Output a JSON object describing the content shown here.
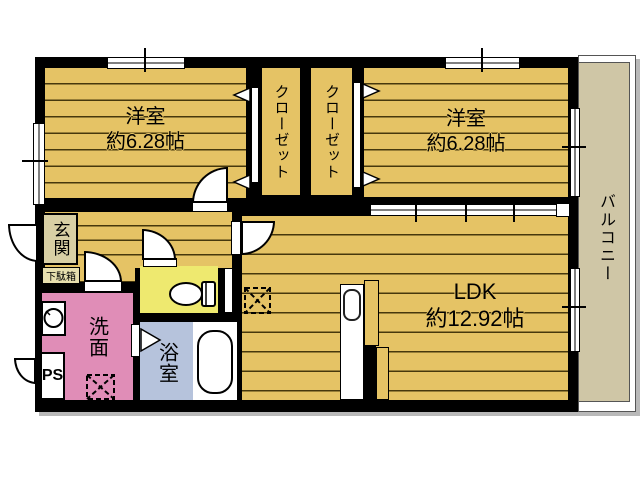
{
  "plan_title": "2LDK apartment floor plan",
  "rooms": {
    "bedroom1": {
      "name": "洋室",
      "size": "約6.28帖"
    },
    "bedroom2": {
      "name": "洋室",
      "size": "約6.28帖"
    },
    "closet1": {
      "name": "クローゼット"
    },
    "closet2": {
      "name": "クローゼット"
    },
    "ldk": {
      "name": "LDK",
      "size": "約12.92帖"
    },
    "balcony": {
      "name": "バルコニー"
    },
    "entrance": {
      "name": "玄関"
    },
    "shoebox": {
      "name": "下駄箱"
    },
    "washroom": {
      "name": "洗面"
    },
    "bathroom": {
      "name": "浴室"
    },
    "pipe_space": {
      "name": "PS"
    }
  },
  "colors": {
    "wood": "#e5c365",
    "plank": "#46380d",
    "toilet": "#eee96f",
    "washroom_pink": "#e08db7",
    "bathroom_blue": "#b6c3dc",
    "entrance_bg": "#d8cfa4",
    "shoebox_bg": "#e7dfae",
    "balcony": "#cfc6a6",
    "wall": "#000000"
  }
}
